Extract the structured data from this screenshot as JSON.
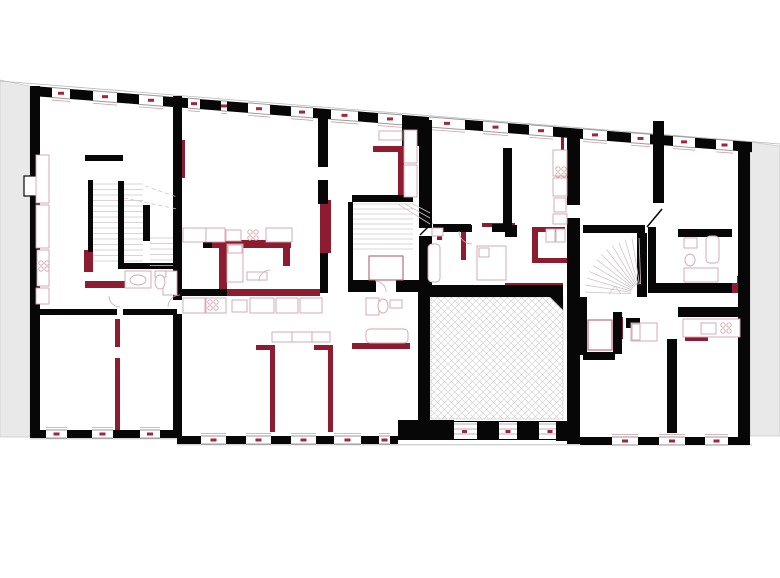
{
  "meta": {
    "type": "architectural-floor-plan",
    "description": "Upper floor plan of a building: black existing walls, dark-red altered walls, hatched courtyard, three stair cores, grey neighbouring buildings",
    "canvas": {
      "w": 780,
      "h": 578
    }
  },
  "colors": {
    "wall_black": "#070707",
    "wall_red": "#8e1c30",
    "dash_red": "#a32638",
    "sill_red": "#d39aa3",
    "furn_stroke": "#d2a6ad",
    "furn_strong": "#b6616e",
    "tread": "#cfc6c6",
    "opening_line": "#9a9a9a",
    "facade_line": "#b8b8b8",
    "neighbor_fill": "#e9e9e9",
    "neighbor_edge": "#c9c9c9",
    "hatch_line": "#cfcfcf"
  },
  "plan": {
    "neighbors": [
      {
        "name": "neighbor-building-left",
        "points": [
          [
            0,
            80
          ],
          [
            30,
            86
          ],
          [
            30,
            437
          ],
          [
            0,
            437
          ]
        ]
      },
      {
        "name": "neighbor-building-right",
        "points": [
          [
            750,
            142
          ],
          [
            780,
            146
          ],
          [
            780,
            436
          ],
          [
            750,
            436
          ]
        ]
      }
    ],
    "facade_lines": [
      [
        0,
        81,
        780,
        144
      ],
      [
        30,
        438.8,
        177,
        438.8
      ],
      [
        177,
        444.8,
        752,
        444.8
      ]
    ],
    "top_wall": {
      "x0": 32,
      "y0": 86,
      "x1": 750,
      "y1": 142,
      "t": 10,
      "piers": [
        [
          32,
          52
        ],
        [
          70,
          93
        ],
        [
          117,
          139
        ],
        [
          163,
          188
        ],
        [
          200,
          221
        ],
        [
          227,
          248
        ],
        [
          270,
          291
        ],
        [
          313,
          331
        ],
        [
          358,
          378
        ],
        [
          402,
          429
        ],
        [
          465,
          483
        ],
        [
          508,
          529
        ],
        [
          553,
          583
        ],
        [
          607,
          631
        ],
        [
          650,
          673
        ],
        [
          695,
          716
        ],
        [
          733,
          752
        ]
      ]
    },
    "bottom_walls": [
      {
        "y": 430,
        "h": 8,
        "piers": [
          [
            30,
            46
          ],
          [
            67,
            92
          ],
          [
            113,
            140
          ],
          [
            160,
            177
          ]
        ]
      },
      {
        "y": 436,
        "h": 8,
        "piers": [
          [
            177,
            201
          ],
          [
            226,
            246
          ],
          [
            271,
            291
          ],
          [
            316,
            334
          ],
          [
            361,
            379
          ],
          [
            390,
            398
          ]
        ]
      },
      {
        "y": 437,
        "h": 8,
        "piers": [
          [
            580,
            612
          ],
          [
            638,
            659
          ],
          [
            685,
            705
          ],
          [
            728,
            750
          ]
        ]
      }
    ],
    "court_band": {
      "bg": [
        398,
        421,
        177,
        19
      ],
      "windows": [
        [
          452,
          477
        ],
        [
          499,
          517
        ],
        [
          539,
          561
        ]
      ],
      "trapezoids": [
        [
          [
            480,
            421
          ],
          [
            496,
            421
          ],
          [
            499,
            440
          ],
          [
            477,
            440
          ]
        ],
        [
          [
            520,
            421
          ],
          [
            536,
            421
          ],
          [
            539,
            440
          ],
          [
            517,
            440
          ]
        ]
      ]
    },
    "black_rects": [
      [
        30,
        86,
        10,
        351
      ],
      [
        738,
        142,
        12,
        302
      ],
      [
        173,
        96,
        9,
        204
      ],
      [
        173,
        314,
        9,
        122
      ],
      [
        402,
        120,
        30,
        26
      ],
      [
        419,
        146,
        13,
        82
      ],
      [
        419,
        236,
        13,
        56
      ],
      [
        418,
        285,
        145,
        12
      ],
      [
        418,
        297,
        12,
        124
      ],
      [
        398,
        420,
        56,
        20
      ],
      [
        556,
        421,
        14,
        20
      ],
      [
        567,
        130,
        13,
        75
      ],
      [
        567,
        218,
        13,
        226
      ],
      [
        503,
        148,
        9,
        84
      ],
      [
        433,
        224,
        38,
        8
      ],
      [
        492,
        224,
        16,
        8
      ],
      [
        583,
        225,
        62,
        8
      ],
      [
        637,
        233,
        10,
        64
      ],
      [
        653,
        121,
        11,
        82
      ],
      [
        648,
        227,
        8,
        56
      ],
      [
        648,
        283,
        84,
        10
      ],
      [
        678,
        229,
        54,
        8
      ],
      [
        678,
        307,
        62,
        10
      ],
      [
        580,
        297,
        7,
        58
      ],
      [
        613,
        312,
        9,
        42
      ],
      [
        583,
        352,
        32,
        8
      ],
      [
        667,
        339,
        10,
        94
      ],
      [
        626,
        318,
        14,
        10
      ],
      [
        85,
        155,
        38,
        6
      ],
      [
        88,
        180,
        5,
        72
      ],
      [
        118,
        181,
        6,
        87
      ],
      [
        143,
        205,
        7,
        36
      ],
      [
        118,
        263,
        59,
        6
      ],
      [
        33,
        309,
        84,
        6
      ],
      [
        123,
        309,
        54,
        6
      ],
      [
        352,
        195,
        61,
        7
      ],
      [
        348,
        202,
        5,
        80
      ],
      [
        348,
        280,
        28,
        12
      ],
      [
        396,
        280,
        34,
        12
      ],
      [
        180,
        289,
        47,
        7
      ],
      [
        203,
        240,
        9,
        8
      ],
      [
        318,
        113,
        10,
        54
      ],
      [
        318,
        180,
        10,
        24
      ],
      [
        320,
        253,
        8,
        40
      ],
      [
        455,
        225,
        17,
        7
      ],
      [
        505,
        225,
        12,
        12
      ]
    ],
    "black_polygons": [
      [
        [
          550,
          297
        ],
        [
          563,
          297
        ],
        [
          563,
          310
        ]
      ]
    ],
    "black_lines": [
      [
        647,
        227,
        662,
        209
      ],
      [
        420,
        235,
        432,
        223
      ]
    ],
    "white_niche": [
      24,
      176,
      16,
      20
    ],
    "red_rects": [
      [
        212,
        240,
        79,
        8
      ],
      [
        219,
        248,
        8,
        42
      ],
      [
        283,
        240,
        7,
        26
      ],
      [
        227,
        289,
        93,
        7
      ],
      [
        320,
        200,
        11,
        53
      ],
      [
        181,
        140,
        4,
        38
      ],
      [
        373,
        146,
        30,
        6
      ],
      [
        398,
        146,
        6,
        54
      ],
      [
        256,
        345,
        19,
        5
      ],
      [
        314,
        345,
        19,
        5
      ],
      [
        270,
        348,
        5,
        84
      ],
      [
        328,
        348,
        5,
        84
      ],
      [
        115,
        319,
        5,
        28
      ],
      [
        115,
        358,
        5,
        72
      ],
      [
        84,
        250,
        9,
        22
      ],
      [
        85,
        281,
        40,
        7
      ],
      [
        352,
        343,
        58,
        6
      ],
      [
        461,
        232,
        5,
        28
      ],
      [
        437,
        232,
        5,
        8
      ],
      [
        532,
        227,
        6,
        36
      ],
      [
        532,
        227,
        33,
        5
      ],
      [
        532,
        258,
        41,
        5
      ],
      [
        482,
        223,
        33,
        4
      ],
      [
        486,
        285,
        14,
        6
      ],
      [
        505,
        283,
        58,
        3
      ],
      [
        730,
        283,
        9,
        10
      ],
      [
        737,
        276,
        5,
        16
      ],
      [
        685,
        336,
        23,
        5
      ],
      [
        618,
        317,
        5,
        22
      ],
      [
        561,
        133,
        3,
        42
      ]
    ],
    "hatch_rect": [
      431,
      297,
      132,
      122
    ],
    "stairs": {
      "straight": [
        {
          "x": 93,
          "y": 184,
          "w": 25,
          "h": 80,
          "step": 5.5
        },
        {
          "x": 124,
          "y": 184,
          "w": 19,
          "h": 80,
          "step": 5.5
        },
        {
          "x": 150,
          "y": 238,
          "w": 23,
          "h": 30,
          "step": 5.5
        },
        {
          "x": 353,
          "y": 204,
          "w": 60,
          "h": 48,
          "step": 5
        }
      ],
      "dashed": [
        [
          145,
          186,
          177,
          197
        ],
        [
          124,
          198,
          177,
          209
        ]
      ],
      "winders": [
        [
          405,
          204,
          430,
          218
        ],
        [
          398,
          204,
          430,
          224
        ],
        [
          413,
          204,
          430,
          213
        ]
      ],
      "fan": {
        "cx": 641,
        "cy": 294,
        "r1": 10,
        "r2": 56,
        "a0": 182,
        "a1": 268,
        "n": 12
      },
      "chevron": [
        [
          609,
          294,
          615,
          286
        ],
        [
          615,
          286,
          621,
          294
        ]
      ]
    },
    "furniture_rects": [
      [
        36,
        155,
        13,
        48
      ],
      [
        36,
        205,
        13,
        43
      ],
      [
        37,
        250,
        12,
        36
      ],
      [
        36,
        288,
        13,
        16
      ],
      [
        183,
        228,
        23,
        14
      ],
      [
        206,
        228,
        19,
        14
      ],
      [
        226,
        230,
        15,
        11
      ],
      [
        266,
        228,
        26,
        14
      ],
      [
        183,
        298,
        22,
        15
      ],
      [
        206,
        298,
        20,
        15
      ],
      [
        232,
        300,
        15,
        12
      ],
      [
        250,
        298,
        24,
        15
      ],
      [
        276,
        298,
        22,
        15
      ],
      [
        300,
        298,
        22,
        15
      ],
      [
        272,
        332,
        20,
        10
      ],
      [
        292,
        332,
        20,
        10
      ],
      [
        312,
        332,
        18,
        10
      ],
      [
        683,
        319,
        57,
        18
      ],
      [
        701,
        323,
        15,
        11
      ],
      [
        553,
        150,
        14,
        26
      ],
      [
        553,
        178,
        14,
        18
      ],
      [
        554,
        198,
        12,
        14
      ],
      [
        553,
        214,
        14,
        10
      ],
      [
        404,
        130,
        13,
        33
      ],
      [
        404,
        165,
        13,
        32
      ],
      [
        379,
        131,
        23,
        9
      ],
      [
        546,
        229,
        9,
        13
      ],
      [
        556,
        229,
        9,
        13
      ],
      [
        227,
        244,
        16,
        38
      ],
      [
        228,
        245,
        14,
        8
      ],
      [
        477,
        246,
        29,
        34
      ],
      [
        479,
        248,
        10,
        9
      ],
      [
        631,
        323,
        26,
        18
      ],
      [
        632,
        324,
        8,
        16
      ],
      [
        247,
        272,
        20,
        8
      ],
      [
        125,
        271,
        26,
        17
      ],
      [
        163,
        271,
        14,
        24
      ],
      [
        155,
        271,
        11,
        6
      ],
      [
        366,
        298,
        13,
        17
      ],
      [
        390,
        300,
        12,
        8
      ],
      [
        432,
        228,
        11,
        8
      ],
      [
        684,
        238,
        13,
        10
      ],
      [
        684,
        268,
        34,
        14
      ]
    ],
    "furniture_round_rects": [
      [
        366,
        329,
        42,
        14
      ],
      [
        428,
        244,
        12,
        38
      ],
      [
        706,
        236,
        13,
        27
      ]
    ],
    "furniture_strong_rects": [
      [
        588,
        320,
        24,
        30
      ],
      [
        369,
        256,
        34,
        24
      ]
    ],
    "hob_groups": [
      [
        41,
        263
      ],
      [
        250,
        232
      ],
      [
        210,
        302
      ],
      [
        723,
        325
      ],
      [
        558,
        169
      ]
    ],
    "ellipses": [
      [
        138,
        280,
        8,
        5
      ],
      [
        160,
        282,
        5,
        7
      ],
      [
        383,
        306,
        5,
        7
      ],
      [
        690,
        260,
        5,
        6
      ]
    ],
    "door_arcs": [
      {
        "cx": 270,
        "cy": 281,
        "r": 11,
        "a0": 180,
        "a1": 270
      },
      {
        "cx": 120,
        "cy": 296,
        "r": 11,
        "a0": 90,
        "a1": 180
      },
      {
        "cx": 472,
        "cy": 231,
        "r": 13,
        "a0": 90,
        "a1": 180
      },
      {
        "cx": 375,
        "cy": 292,
        "r": 11,
        "a0": 270,
        "a1": 360
      },
      {
        "cx": 180,
        "cy": 307,
        "r": 12,
        "a0": 180,
        "a1": 270
      }
    ]
  }
}
